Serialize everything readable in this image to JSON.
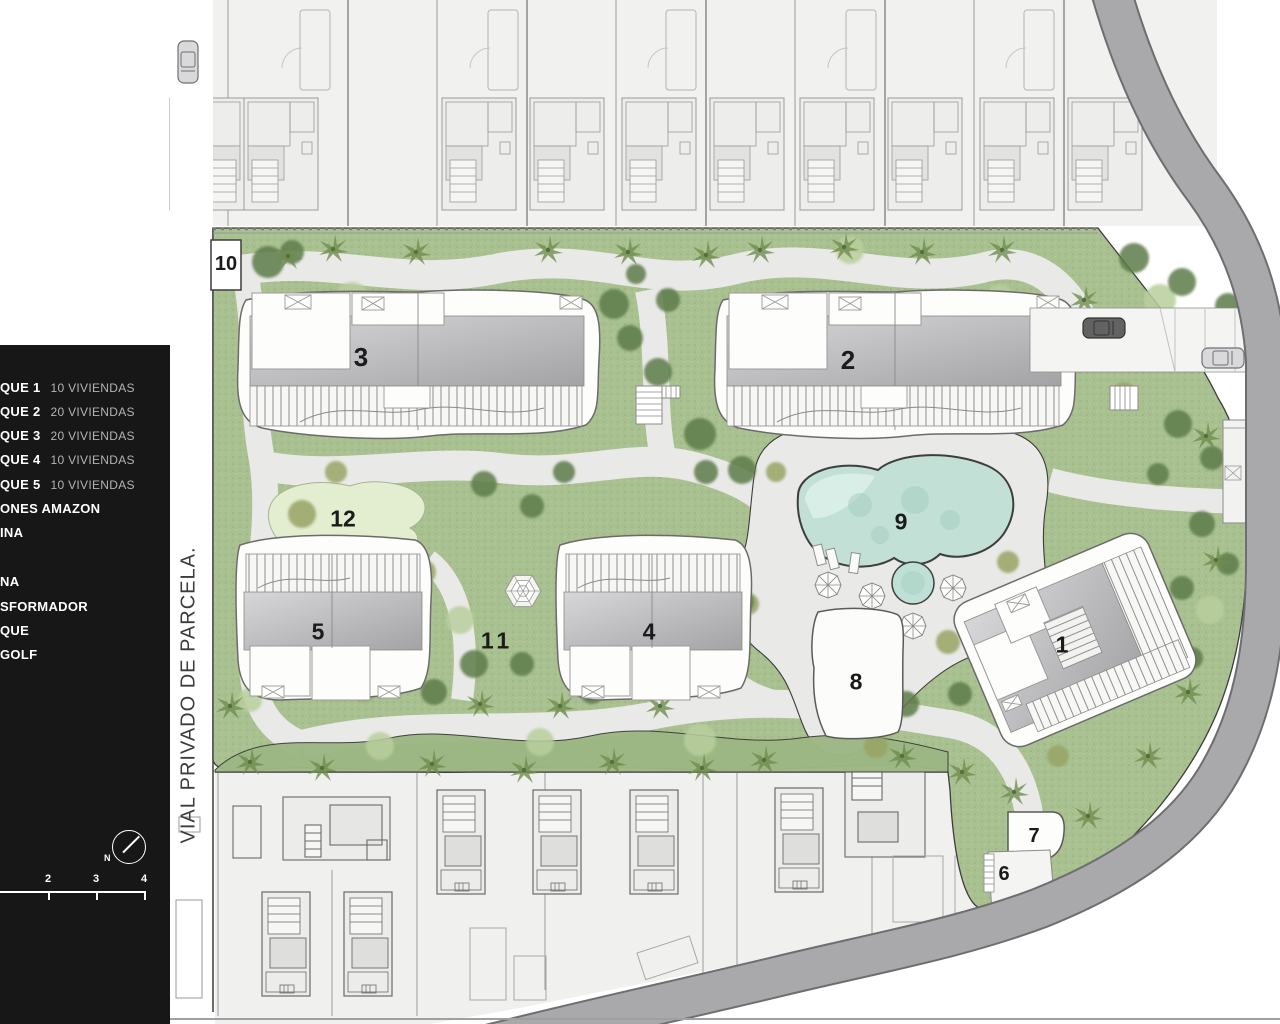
{
  "legend": {
    "rows": [
      {
        "name": "QUE 1",
        "value": "10 VIVIENDAS"
      },
      {
        "name": "QUE 2",
        "value": "20 VIVIENDAS"
      },
      {
        "name": "QUE 3",
        "value": "20 VIVIENDAS"
      },
      {
        "name": "QUE 4",
        "value": "10 VIVIENDAS"
      },
      {
        "name": "QUE 5",
        "value": "10 VIVIENDAS"
      },
      {
        "name": "ONES AMAZON",
        "value": ""
      },
      {
        "name": "INA",
        "value": ""
      },
      {
        "name": "NA",
        "value": ""
      },
      {
        "name": "SFORMADOR",
        "value": ""
      },
      {
        "name": "QUE",
        "value": ""
      },
      {
        "name": "GOLF",
        "value": ""
      }
    ]
  },
  "map_labels": {
    "block3": "3",
    "block2": "2",
    "area12": "12",
    "pool9": "9",
    "block5": "5",
    "area11": "11",
    "block4": "4",
    "area8": "8",
    "block1": "1",
    "box10": "10",
    "box7": "7",
    "area6": "6"
  },
  "road_label": "VIAL PRIVADO DE PARCELA.",
  "compass": {
    "label": "N"
  },
  "scale": {
    "ticks": [
      "2",
      "3",
      "4"
    ]
  },
  "colors": {
    "grass": "#a9c191",
    "pool": "#c2e0d6",
    "road": "#a9a9ac",
    "panel": "#171717",
    "path": "#e9e9e8"
  }
}
